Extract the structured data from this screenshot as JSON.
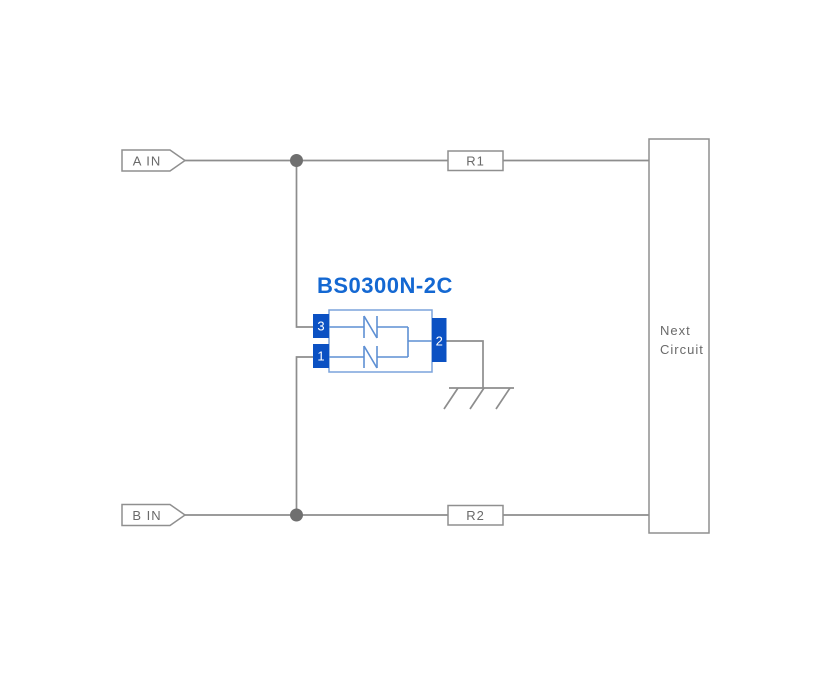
{
  "diagram": {
    "component": {
      "label": "BS0300N-2C",
      "pins": {
        "left_top": "3",
        "left_bottom": "1",
        "right": "2"
      }
    },
    "inputs": {
      "a": "A IN",
      "b": "B IN"
    },
    "resistors": {
      "r1": "R1",
      "r2": "R2"
    },
    "next_circuit": {
      "line1": "Next",
      "line2": "Circuit"
    },
    "colors": {
      "wire_gray": "#8d8d8d",
      "junction_gray": "#6f6f6f",
      "box_border_gray": "#8f8f8f",
      "label_gray": "#6a6a6a",
      "pin_blue": "#0b51c3",
      "component_outline_blue": "#7ba3dc",
      "diode_blue": "#5d8fd3",
      "title_blue": "#1468d2",
      "background": "#ffffff"
    }
  }
}
